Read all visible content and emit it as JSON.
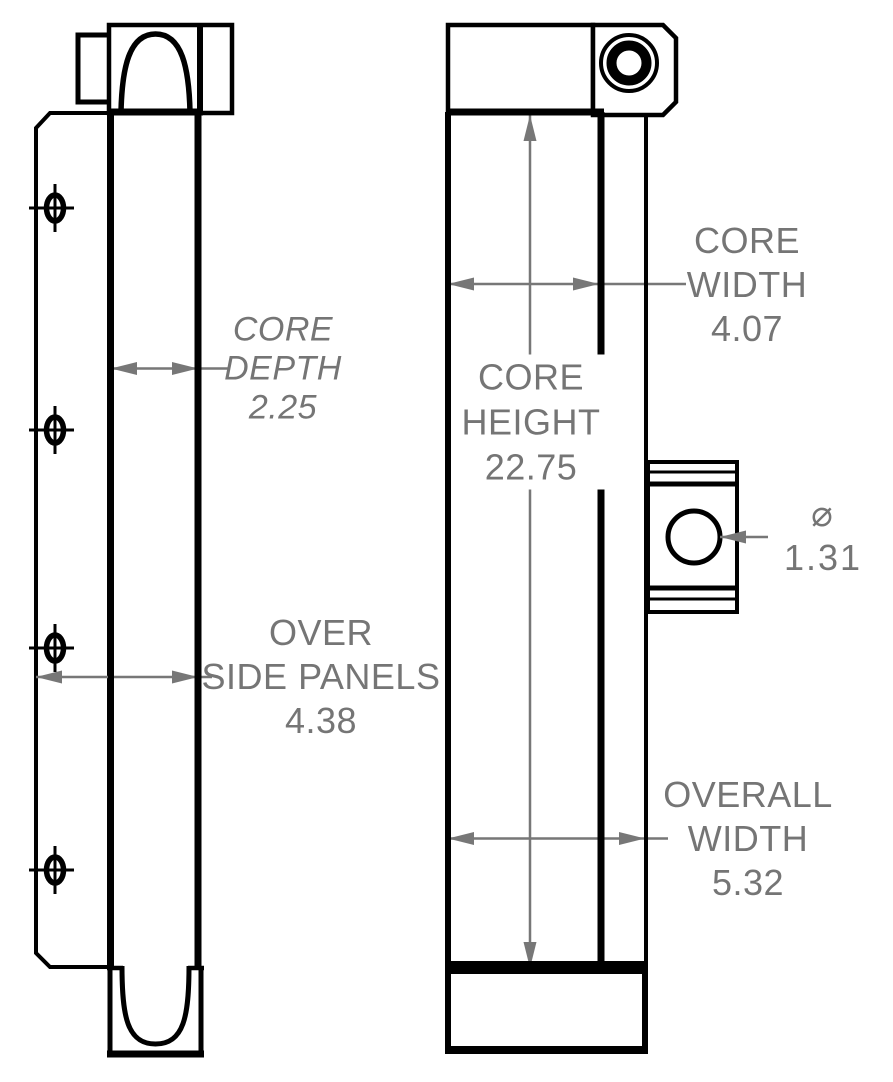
{
  "drawing": {
    "background_color": "#ffffff",
    "line_color": "#000000",
    "dimension_color": "#777777",
    "text_color": "#757575",
    "dimensions": {
      "core_depth": {
        "display": "CORE\nDEPTH\n2.25",
        "value": 2.25
      },
      "over_side_panels": {
        "display": "OVER\nSIDE PANELS\n4.38",
        "value": 4.38
      },
      "core_height": {
        "display": "CORE\nHEIGHT\n22.75",
        "value": 22.75
      },
      "core_width": {
        "display": "CORE\nWIDTH\n4.07",
        "value": 4.07
      },
      "port_diameter": {
        "display": "⌀ 1.31",
        "value": 1.31
      },
      "overall_width": {
        "display": "OVERALL\nWIDTH\n5.32",
        "value": 5.32
      }
    }
  }
}
